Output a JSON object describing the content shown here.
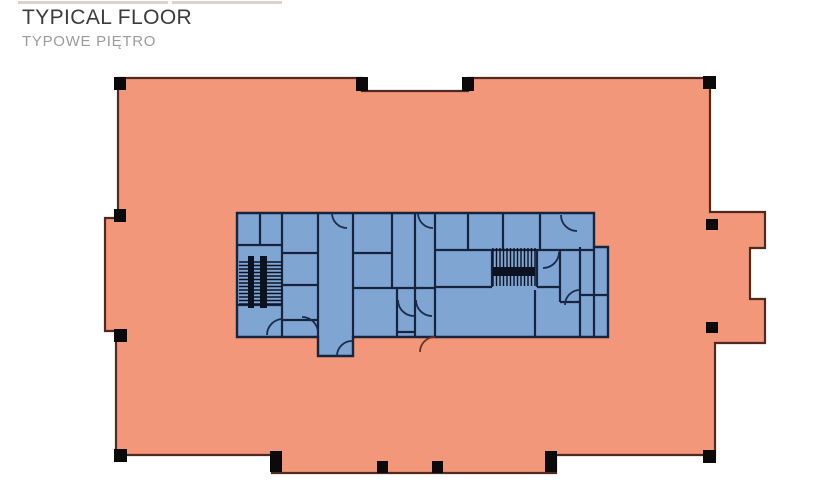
{
  "title": {
    "text": "TYPICAL FLOOR",
    "subtitle": "TYPOWE PIĘTRO"
  },
  "colors": {
    "floor_fill": "#f29779",
    "floor_stroke": "#53281e",
    "core_fill": "#7fa5d2",
    "core_stroke": "#17243f",
    "column_fill": "#0a0a0a",
    "stair_rail": "#0b1322",
    "door_arc": "#1b2b4d",
    "door_arc_exterior": "#6b3226",
    "artifact": "#d8d5d0"
  },
  "page": {
    "artifact_bars": [
      [
        18,
        1,
        150,
        3
      ],
      [
        172,
        1,
        110,
        3
      ]
    ]
  },
  "floorplan": {
    "outline": "M118,78 L362,78 L362,91 L468,91 L468,78 L710,78 L710,212 L765,212 L765,248 L750,248 L750,299 L765,299 L765,343 L715,343 L715,455 L556,455 L556,473 L272,473 L272,455 L116,455 L116,331 L105,331 L105,218 L118,218 Z",
    "core_outline": "M237,213 L594,213 L594,247 L608,247 L608,337 L353,337 L353,356 L318,356 L318,337 L237,337 Z",
    "walls": [
      [
        260,
        213,
        260,
        245
      ],
      [
        282,
        213,
        282,
        337
      ],
      [
        318,
        213,
        318,
        337
      ],
      [
        353,
        213,
        353,
        337
      ],
      [
        392,
        213,
        392,
        288
      ],
      [
        415,
        213,
        415,
        337
      ],
      [
        435,
        213,
        435,
        337
      ],
      [
        468,
        213,
        468,
        250
      ],
      [
        503,
        213,
        503,
        250
      ],
      [
        540,
        213,
        540,
        250
      ],
      [
        594,
        247,
        594,
        337
      ],
      [
        580,
        247,
        580,
        337
      ],
      [
        560,
        250,
        560,
        302
      ],
      [
        397,
        288,
        397,
        337
      ],
      [
        535,
        290,
        535,
        337
      ],
      [
        492,
        250,
        492,
        287
      ],
      [
        537,
        250,
        537,
        287
      ],
      [
        237,
        245,
        282,
        245
      ],
      [
        237,
        305,
        282,
        305
      ],
      [
        282,
        253,
        318,
        253
      ],
      [
        282,
        285,
        318,
        285
      ],
      [
        282,
        320,
        318,
        320
      ],
      [
        353,
        253,
        392,
        253
      ],
      [
        353,
        288,
        435,
        288
      ],
      [
        435,
        250,
        594,
        250
      ],
      [
        435,
        287,
        492,
        287
      ],
      [
        537,
        287,
        560,
        287
      ],
      [
        560,
        302,
        580,
        302
      ],
      [
        580,
        295,
        608,
        295
      ],
      [
        397,
        332,
        415,
        332
      ]
    ],
    "stairs": [
      {
        "orientation": "h",
        "x1": 239,
        "x2": 282,
        "y1": 262,
        "y2": 304,
        "step": 3.5,
        "rails": [
          [
            248,
            256,
            6,
            52
          ],
          [
            260,
            256,
            7,
            52
          ]
        ]
      },
      {
        "orientation": "v",
        "x1": 493,
        "x2": 535,
        "y1": 248,
        "y2": 286,
        "step": 3.5,
        "rails": [
          [
            493,
            267,
            42,
            9
          ]
        ]
      }
    ],
    "door_arcs": [
      {
        "d": "M332,213 A15,15 0 0 0 347,228"
      },
      {
        "d": "M418,213 A15,15 0 0 0 433,228"
      },
      {
        "d": "M337,356 A15,15 0 0 1 352,341"
      },
      {
        "d": "M420,352 A15,15 0 0 1 435,337",
        "exterior": true
      },
      {
        "d": "M267,335 A16,16 0 0 1 283,319"
      },
      {
        "d": "M302,317 A16,16 0 0 1 318,332"
      },
      {
        "d": "M398,300 A16,16 0 0 0 414,316"
      },
      {
        "d": "M416,300 A16,16 0 0 0 432,316"
      },
      {
        "d": "M561,215 A16,16 0 0 0 577,231"
      },
      {
        "d": "M559,252 A16,16 0 0 1 543,268"
      },
      {
        "d": "M565,305 A15,15 0 0 1 580,290"
      }
    ],
    "columns": [
      [
        114,
        77,
        12,
        13
      ],
      [
        356,
        77,
        12,
        14
      ],
      [
        462,
        77,
        12,
        14
      ],
      [
        703,
        76,
        13,
        13
      ],
      [
        706,
        219,
        12,
        11
      ],
      [
        706,
        322,
        12,
        11
      ],
      [
        703,
        450,
        13,
        13
      ],
      [
        114,
        449,
        13,
        13
      ],
      [
        114,
        329,
        13,
        13
      ],
      [
        114,
        209,
        12,
        13
      ],
      [
        270,
        451,
        12,
        21
      ],
      [
        545,
        451,
        12,
        21
      ],
      [
        377,
        461,
        11,
        12
      ],
      [
        432,
        461,
        11,
        12
      ]
    ]
  }
}
